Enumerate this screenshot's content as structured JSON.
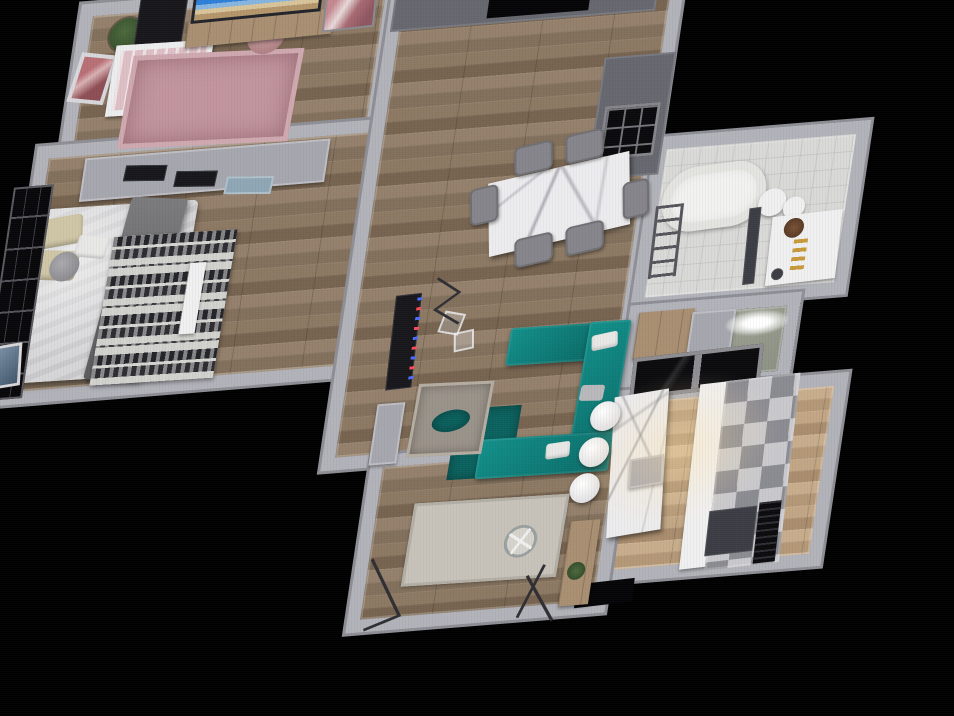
{
  "meta": {
    "view_type": "3d-floorplan-overhead-render",
    "background_color": "#000000"
  },
  "palette": {
    "wall": "#b2b2ba",
    "wall_dark": "#67676f",
    "wood_floor": "#8c7764",
    "wood_floor_light": "#c0a585",
    "tile_floor": "#d9d9d7",
    "wc_floor_green": "#a9ad9e",
    "sofa_teal": "#0f8480",
    "rug_teal_dark": "#0b615e",
    "nursery_rug_pink": "#c2959e",
    "marble": "#ececee",
    "led_blue": "#4a6cff",
    "led_red": "#ff4a5a",
    "gold_accent": "#c79a3a",
    "window_black": "#08080a"
  },
  "scene": {
    "origin": {
      "left": 95,
      "top": 15
    },
    "matrix": [
      0.997,
      -0.081,
      -0.148,
      0.989,
      0,
      0
    ],
    "rooms": [
      {
        "name": "nursery",
        "floor": "wood",
        "box": [
          -15,
          -12,
          320,
          155
        ]
      },
      {
        "name": "master-bedroom",
        "floor": "wood",
        "box": [
          -38,
          130,
          362,
          262
        ]
      },
      {
        "name": "living-room",
        "floor": "wood",
        "box": [
          298,
          -22,
          296,
          508
        ]
      },
      {
        "name": "bathroom",
        "floor": "tile",
        "box": [
          588,
          172,
          216,
          176
        ]
      },
      {
        "name": "water-closet",
        "floor": "green",
        "box": [
          588,
          342,
          172,
          92
        ]
      },
      {
        "name": "kitchen",
        "floor": "wood-light",
        "box": [
          588,
          428,
          232,
          196
        ]
      },
      {
        "name": "balcony",
        "floor": "wood",
        "box": [
          348,
          474,
          260,
          180
        ]
      }
    ],
    "items": [
      {
        "name": "nursery-plant",
        "cls": "plant",
        "box": [
          18,
          6,
          34,
          34,
          0
        ]
      },
      {
        "name": "nursery-desk",
        "cls": "black-unit",
        "box": [
          44,
          -14,
          48,
          52,
          0
        ]
      },
      {
        "name": "nursery-wall-art",
        "cls": "art-pink",
        "box": [
          -12,
          40,
          38,
          50,
          10
        ]
      },
      {
        "name": "crib",
        "cls": "crib",
        "box": [
          26,
          34,
          98,
          72,
          1
        ]
      },
      {
        "name": "nursery-rug",
        "cls": "rug-pink",
        "box": [
          44,
          48,
          172,
          94,
          2
        ]
      },
      {
        "name": "nursery-pouf",
        "cls": "pouf-pink",
        "box": [
          158,
          16,
          38,
          38,
          0
        ]
      },
      {
        "name": "tv-cabinet",
        "cls": "wood-cab",
        "box": [
          96,
          14,
          146,
          26,
          -1
        ]
      },
      {
        "name": "tv-screen",
        "cls": "tv-screen",
        "box": [
          98,
          -14,
          130,
          30,
          -1
        ]
      },
      {
        "name": "nursery-wall-art-2",
        "cls": "art-pink2",
        "box": [
          232,
          -6,
          52,
          42,
          -2
        ]
      },
      {
        "name": "wardrobe",
        "cls": "cab-gray",
        "box": [
          12,
          146,
          246,
          44,
          0
        ]
      },
      {
        "name": "wardrobe-drawer-1",
        "cls": "black-unit",
        "box": [
          54,
          158,
          42,
          16,
          4
        ]
      },
      {
        "name": "wardrobe-drawer-2",
        "cls": "black-unit",
        "box": [
          106,
          168,
          42,
          16,
          4
        ]
      },
      {
        "name": "wardrobe-drawer-3",
        "cls": "drawer-blue",
        "box": [
          158,
          178,
          48,
          18,
          4
        ]
      },
      {
        "name": "bed",
        "cls": "bed",
        "box": [
          -32,
          196,
          164,
          176,
          1
        ]
      },
      {
        "name": "bed-pillow-1",
        "cls": "pillow",
        "box": [
          -26,
          204,
          46,
          30,
          -6
        ]
      },
      {
        "name": "bed-pillow-2",
        "cls": "pillow",
        "box": [
          -26,
          238,
          46,
          30,
          6
        ]
      },
      {
        "name": "bed-pillow-3",
        "cls": "pillow-white",
        "box": [
          16,
          226,
          32,
          22,
          10
        ]
      },
      {
        "name": "bed-throw",
        "cls": "throw",
        "box": [
          54,
          192,
          58,
          184,
          7
        ]
      },
      {
        "name": "aztec-rug",
        "cls": "rug-aztec",
        "box": [
          52,
          230,
          124,
          150,
          1
        ]
      },
      {
        "name": "bedside-stool",
        "cls": "stool-gray",
        "box": [
          -8,
          240,
          30,
          30,
          0
        ]
      },
      {
        "name": "bedroom-window",
        "cls": "window-black",
        "box": [
          -56,
          170,
          40,
          216,
          0
        ]
      },
      {
        "name": "bedroom-picture",
        "cls": "art-blue",
        "box": [
          -52,
          330,
          30,
          44,
          -5
        ]
      },
      {
        "name": "bed-bench",
        "cls": "white-f",
        "box": [
          134,
          262,
          16,
          72,
          1
        ]
      },
      {
        "name": "entry-wall",
        "cls": "wall-dark",
        "box": [
          302,
          -22,
          266,
          64,
          0
        ]
      },
      {
        "name": "entry-doorway",
        "cls": "black",
        "box": [
          398,
          -22,
          102,
          58,
          0
        ]
      },
      {
        "name": "hall-wall",
        "cls": "wall-dark",
        "box": [
          524,
          86,
          72,
          124,
          0
        ]
      },
      {
        "name": "hall-grid-window",
        "cls": "grid-black",
        "box": [
          532,
          136,
          56,
          54,
          0
        ]
      },
      {
        "name": "dining-table",
        "cls": "marble",
        "box": [
          430,
          194,
          140,
          76,
          -9
        ]
      },
      {
        "name": "dining-chair-1",
        "cls": "chair",
        "box": [
          448,
          168,
          38,
          30,
          -9
        ]
      },
      {
        "name": "dining-chair-2",
        "cls": "chair",
        "box": [
          498,
          160,
          38,
          30,
          -9
        ]
      },
      {
        "name": "dining-chair-3",
        "cls": "chair",
        "box": [
          462,
          262,
          38,
          30,
          -9
        ]
      },
      {
        "name": "dining-chair-4",
        "cls": "chair",
        "box": [
          512,
          254,
          38,
          30,
          -9
        ]
      },
      {
        "name": "dining-chair-5",
        "cls": "chair",
        "box": [
          410,
          208,
          28,
          38,
          -9
        ]
      },
      {
        "name": "dining-chair-6",
        "cls": "chair",
        "box": [
          564,
          214,
          26,
          38,
          -9
        ]
      },
      {
        "name": "wall-tv",
        "cls": "black-unit",
        "box": [
          350,
          312,
          26,
          96,
          -2
        ]
      },
      {
        "name": "wall-tv-led",
        "cls": "led",
        "box": [
          372,
          316,
          5,
          88,
          -2
        ]
      },
      {
        "name": "hall-cabinet",
        "cls": "cab-gray",
        "box": [
          346,
          422,
          28,
          62,
          0
        ]
      },
      {
        "name": "sofa-rug",
        "cls": "teal-dark",
        "box": [
          428,
          434,
          64,
          72,
          1
        ]
      },
      {
        "name": "sofa-arm-top",
        "cls": "teal",
        "box": [
          470,
          356,
          84,
          38,
          1
        ]
      },
      {
        "name": "sofa-right",
        "cls": "teal",
        "box": [
          548,
          356,
          42,
          150,
          1
        ]
      },
      {
        "name": "sofa-arm-bottom",
        "cls": "teal",
        "box": [
          456,
          468,
          134,
          40,
          1
        ]
      },
      {
        "name": "sofa-pillow-1",
        "cls": "pillow-white",
        "box": [
          554,
          368,
          26,
          16,
          -8
        ]
      },
      {
        "name": "sofa-pillow-2",
        "cls": "pillow-gray",
        "box": [
          550,
          420,
          24,
          16,
          4
        ]
      },
      {
        "name": "sofa-pillow-3",
        "cls": "pillow-white",
        "box": [
          524,
          476,
          24,
          16,
          -4
        ]
      },
      {
        "name": "ottoman-rug",
        "cls": "rug-fray",
        "box": [
          384,
          406,
          76,
          74,
          2
        ]
      },
      {
        "name": "ottoman-tray",
        "cls": "teal-dark round",
        "box": [
          404,
          434,
          38,
          22,
          -6
        ]
      },
      {
        "name": "glass-table-1",
        "cls": "glass",
        "box": [
          398,
          334,
          22,
          22,
          14
        ]
      },
      {
        "name": "glass-table-2",
        "cls": "glass",
        "box": [
          414,
          354,
          20,
          20,
          -8
        ]
      },
      {
        "name": "wc-cabinet",
        "cls": "wood-cab",
        "box": [
          598,
          350,
          56,
          48,
          0
        ]
      },
      {
        "name": "wc-unit",
        "cls": "cab-gray",
        "box": [
          652,
          354,
          44,
          48,
          0
        ]
      },
      {
        "name": "wc-ceiling-light",
        "cls": "light-oval",
        "box": [
          688,
          358,
          62,
          24,
          0
        ]
      },
      {
        "name": "kitchen-window",
        "cls": "window-glass",
        "box": [
          600,
          394,
          130,
          42,
          -2
        ]
      },
      {
        "name": "kitchen-island",
        "cls": "marble",
        "box": [
          592,
          432,
          54,
          144,
          -5
        ]
      },
      {
        "name": "island-shelf",
        "cls": "cab-gray",
        "box": [
          612,
          498,
          34,
          30,
          -5
        ]
      },
      {
        "name": "bar-stool-1",
        "cls": "stool-white",
        "box": [
          564,
          438,
          30,
          30,
          0
        ]
      },
      {
        "name": "bar-stool-2",
        "cls": "stool-white",
        "box": [
          558,
          474,
          30,
          30,
          0
        ]
      },
      {
        "name": "bar-stool-3",
        "cls": "stool-white",
        "box": [
          554,
          510,
          30,
          30,
          0
        ]
      },
      {
        "name": "counter-top",
        "cls": "white-f",
        "box": [
          674,
          428,
          28,
          188,
          -2
        ]
      },
      {
        "name": "counter-cabinets",
        "cls": "checker",
        "box": [
          700,
          426,
          74,
          192,
          -2
        ]
      },
      {
        "name": "oven",
        "cls": "dark-unit",
        "box": [
          700,
          558,
          48,
          46,
          -2
        ]
      },
      {
        "name": "vent-grille",
        "cls": "grille",
        "box": [
          750,
          554,
          22,
          62,
          -2
        ]
      },
      {
        "name": "balcony-doorway",
        "cls": "black",
        "box": [
          576,
          622,
          58,
          24,
          -2
        ]
      },
      {
        "name": "kitchen-light-glow",
        "cls": "glow",
        "box": [
          548,
          408,
          220,
          170,
          0
        ]
      },
      {
        "name": "bathtub",
        "cls": "tub",
        "box": [
          604,
          204,
          104,
          66,
          -3
        ]
      },
      {
        "name": "towel-ladder",
        "cls": "ladder",
        "box": [
          600,
          242,
          28,
          74,
          -2
        ]
      },
      {
        "name": "sink-1",
        "cls": "white-f round",
        "box": [
          702,
          234,
          28,
          28,
          0
        ]
      },
      {
        "name": "sink-2",
        "cls": "white-f round",
        "box": [
          728,
          244,
          22,
          22,
          0
        ]
      },
      {
        "name": "bath-partition",
        "cls": "dark-unit",
        "box": [
          696,
          252,
          12,
          78,
          -3
        ]
      },
      {
        "name": "vanity",
        "cls": "white-f",
        "box": [
          720,
          262,
          70,
          70,
          -2
        ]
      },
      {
        "name": "vanity-plant",
        "cls": "decor-brown",
        "box": [
          732,
          266,
          20,
          20,
          0
        ]
      },
      {
        "name": "gold-bottles",
        "cls": "gold",
        "box": [
          744,
          288,
          14,
          32,
          0
        ]
      },
      {
        "name": "floor-drain",
        "cls": "dark-unit round",
        "box": [
          726,
          316,
          12,
          12,
          0
        ]
      },
      {
        "name": "balcony-rug",
        "cls": "rug-light",
        "box": [
          398,
          528,
          156,
          84,
          1
        ]
      },
      {
        "name": "balcony-cabinet",
        "cls": "wood-cab",
        "box": [
          560,
          558,
          30,
          86,
          0
        ]
      },
      {
        "name": "balcony-plant",
        "cls": "plant-green",
        "box": [
          564,
          600,
          18,
          18,
          0
        ]
      }
    ]
  }
}
